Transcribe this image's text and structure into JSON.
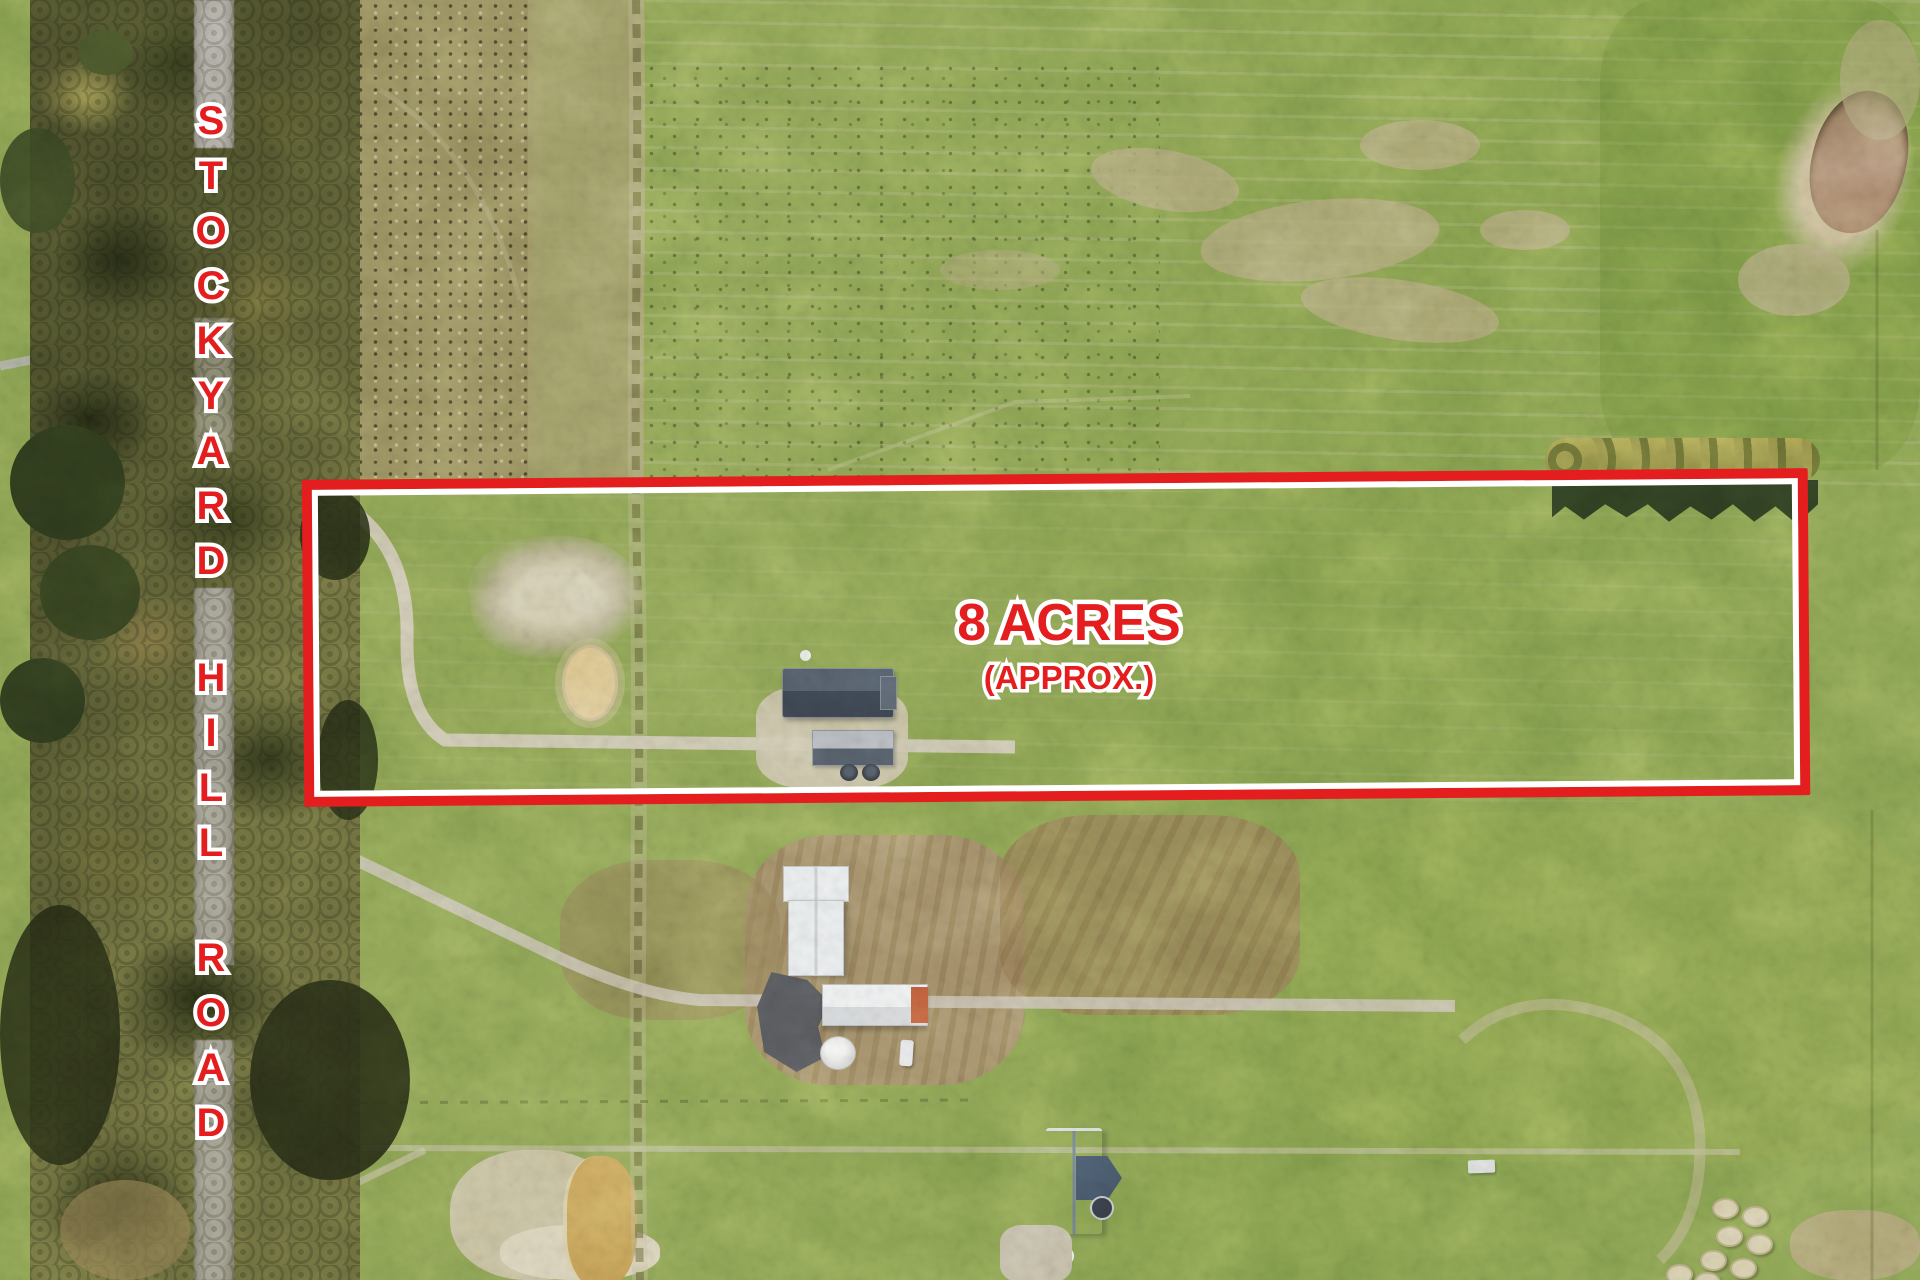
{
  "annotations": {
    "road_name": "STOCKYARD HILL ROAD",
    "area": "8 ACRES",
    "area_qualifier": "(APPROX.)"
  },
  "colors": {
    "annotation_red": "#e41e1f",
    "annotation_outline": "#ffffff"
  }
}
